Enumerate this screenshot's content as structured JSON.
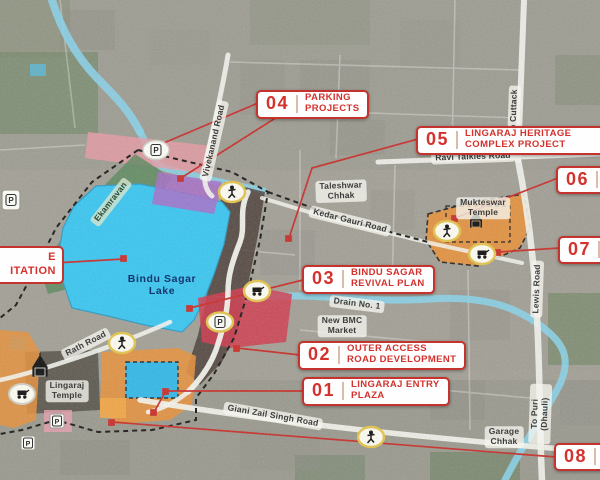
{
  "callouts": [
    {
      "number": "01",
      "label": "LINGARAJ ENTRY\nPLAZA"
    },
    {
      "number": "02",
      "label": "OUTER ACCESS\nROAD DEVELOPMENT"
    },
    {
      "number": "03",
      "label": "BINDU SAGAR\nREVIVAL PLAN"
    },
    {
      "number": "04",
      "label": "PARKING\nPROJECTS"
    },
    {
      "number": "05",
      "label": "LINGARAJ HERITAGE\nCOMPLEX PROJECT"
    },
    {
      "number": "06",
      "label": ""
    },
    {
      "number": "07",
      "label": ""
    },
    {
      "number": "08",
      "label": ""
    }
  ],
  "partial_callout": {
    "text": "E\nITATION"
  },
  "map_labels": {
    "lake": "Bindu Sagar\nLake",
    "lingaraj_temple": "Lingaraj\nTemple",
    "mukteswar_temple": "Mukteswar\nTemple",
    "taleshwar_chhak": "Taleshwar\nChhak",
    "garage_chhak": "Garage\nChhak",
    "new_bmc_market": "New BMC\nMarket",
    "drain_no_1": "Drain No. 1",
    "ekamravan": "Ekamravan"
  },
  "road_labels": {
    "vivekanand": "Vivekanand Road",
    "to_cuttack": "To Cuttack",
    "ravi_talkies": "Ravi Talkies Road",
    "kedar_gauri": "Kedar Gauri Road",
    "lewis": "Lewis Road",
    "rath": "Rath Road",
    "giani_zail_singh": "Giani Zail Singh Road",
    "to_puri": "To Puri (Dhauli)"
  },
  "icons": {
    "parking_glyph": "P"
  },
  "colors": {
    "accent_red": "#c4332e",
    "lake_blue": "#3cc6f0",
    "zone_orange": "#e8923c",
    "zone_purple": "#a86fc9",
    "zone_red": "#d23c50",
    "zone_green": "#5d8a5f",
    "stream_blue": "#8ad2e8"
  }
}
